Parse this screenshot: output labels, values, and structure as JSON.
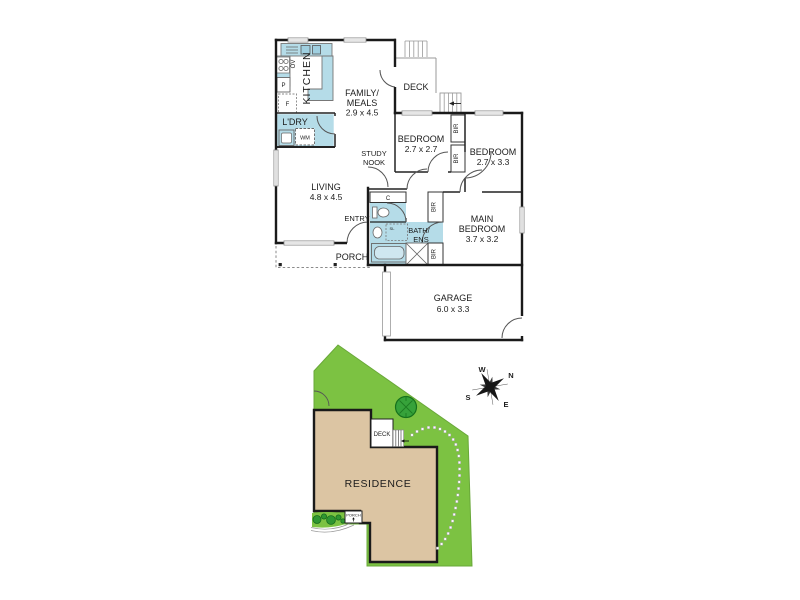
{
  "floor_plan": {
    "kitchen": {
      "label": "KITCHEN",
      "oven": "OV",
      "pantry": "P",
      "fridge": "F"
    },
    "family_meals": {
      "line1": "FAMILY/",
      "line2": "MEALS",
      "dims": "2.9 x 4.5"
    },
    "deck": {
      "label": "DECK"
    },
    "laundry": {
      "label": "L'DRY",
      "washing_machine": "WM"
    },
    "study_nook": {
      "line1": "STUDY",
      "line2": "NOOK"
    },
    "bedroom1": {
      "label": "BEDROOM",
      "dims": "2.7 x 2.7"
    },
    "bedroom2": {
      "label": "BEDROOM",
      "dims": "2.7 x 3.3"
    },
    "main_bedroom": {
      "line1": "MAIN",
      "line2": "BEDROOM",
      "dims": "3.7 x 3.2"
    },
    "living": {
      "label": "LIVING",
      "dims": "4.8 x 4.5"
    },
    "entry": {
      "label": "ENTRY"
    },
    "porch": {
      "label": "PORCH"
    },
    "bath_ens": {
      "line1": "BATH/",
      "line2": "ENS",
      "cupboard": "C",
      "skylight": "SL"
    },
    "garage": {
      "label": "GARAGE",
      "dims": "6.0 x 3.3"
    },
    "built_in_robe": "BIR"
  },
  "site_plan": {
    "residence_label": "RESIDENCE",
    "deck_label": "DECK",
    "porch_label": "PORCH",
    "compass": {
      "north": "N",
      "south": "S",
      "east": "E",
      "west": "W"
    }
  },
  "colors": {
    "wet_area": "#b5dce8",
    "lawn": "#7cc242",
    "residence": "#dcc5a3",
    "tree_canopy": "#36a23a",
    "shrub": "#2f9631",
    "wall": "#1a1a1a",
    "background": "#ffffff"
  }
}
